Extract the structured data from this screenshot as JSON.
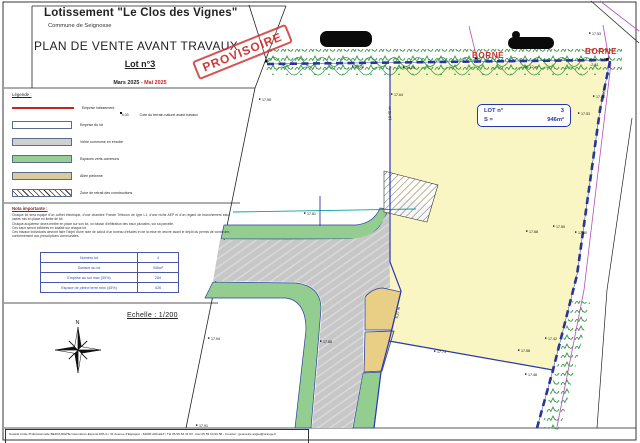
{
  "title_block": {
    "title": "Lotissement \"Le Clos des Vignes\"",
    "commune": "Commune de Seignosse",
    "plan_title": "PLAN DE VENTE AVANT TRAVAUX",
    "lot": "Lot n°3",
    "date_black": "Mars 2025",
    "date_red": "- Mai 2025",
    "stamp": "PROVISOIRE"
  },
  "legend": {
    "heading": "Légende :",
    "items": [
      {
        "swatch": "line-red",
        "label": "Emprise lotissement"
      },
      {
        "swatch": "white",
        "label": "Emprise du lot"
      },
      {
        "swatch": "gray",
        "label": "Voirie commune en enrobé"
      },
      {
        "swatch": "green",
        "label": "Espaces verts communs"
      },
      {
        "swatch": "tan",
        "label": "Allée piétonne"
      },
      {
        "swatch": "hatch",
        "label": "Zone de retrait des constructions"
      }
    ],
    "cote_value": "4.03",
    "cote_label": "Cote du terrain naturel avant travaux"
  },
  "notes": {
    "heading": "Nota importante :",
    "lines": [
      "Chaque lot sera équipé d'un coffret électrique, d'une chambre France Télécom de type L1, d'une niche AEP et d'un regard de branchement eaux usées mis en place en limite de lot.",
      "Chaque acquéreur devra mettre en place sur son lot, un bassin d'infiltration des eaux pluviales, sur sa parcelle.",
      "Ces eaux seront infiltrées en totalité sur chaque lot.",
      "Ces travaux individuels devront faire l'objet d'une note de calcul d'un bureau d'études et de la mise en œuvre avant le dépôt du permis de construire, conformément aux prescriptions communales."
    ]
  },
  "table": {
    "rows": [
      {
        "label": "Numéro lot",
        "value": "4"
      },
      {
        "label": "Surface du lot",
        "value": "946m²"
      },
      {
        "label": "Emprise au sol max (30%)",
        "value": "284"
      },
      {
        "label": "Espace de pleine terre mini (45%)",
        "value": "426"
      }
    ]
  },
  "scale": {
    "label": "Echelle : 1/200"
  },
  "north": {
    "label": "N"
  },
  "footer": {
    "text": "Société Civile Professionnelle BEDOURGHE Géomètres-Experts DPLG / 41 Avenue d'Espagne - 64600 ANGLET / Tél 05 59 63 31 03 - Fax 05 59 63 90 58 - Courriel : geometre.anglet@orange.fr"
  },
  "plan": {
    "lot_box": {
      "line1_label": "LOT n°",
      "line1_value": "3",
      "line2_label": "S =",
      "line2_value": "946m²"
    },
    "borne_labels": [
      {
        "x": 472,
        "y": 58,
        "text": "BORNE"
      },
      {
        "x": 585,
        "y": 54,
        "text": "BORNE"
      }
    ],
    "measurements": [
      {
        "x": 531,
        "y": 68,
        "rot": 0,
        "anchor": "middle",
        "text": "16.12 m"
      },
      {
        "x": 590,
        "y": 66,
        "rot": 0,
        "anchor": "start",
        "text": "-2.81"
      },
      {
        "x": 605,
        "y": 93,
        "rot": -80,
        "anchor": "middle",
        "text": "-7.60 m"
      },
      {
        "x": 391,
        "y": 114,
        "rot": -92,
        "anchor": "middle",
        "text": "-13.45 m"
      },
      {
        "x": 399,
        "y": 313,
        "rot": -78,
        "anchor": "middle",
        "text": "6.27 m"
      }
    ],
    "elevation_points": [
      {
        "x": 262,
        "y": 101,
        "v": "17.90"
      },
      {
        "x": 394,
        "y": 96,
        "v": "17.64"
      },
      {
        "x": 355,
        "y": 68,
        "v": "17.26"
      },
      {
        "x": 406,
        "y": 69,
        "v": "14.29"
      },
      {
        "x": 592,
        "y": 35,
        "v": "17.53"
      },
      {
        "x": 596,
        "y": 98,
        "v": "17.42"
      },
      {
        "x": 581,
        "y": 115,
        "v": "17.53"
      },
      {
        "x": 556,
        "y": 228,
        "v": "17.50"
      },
      {
        "x": 578,
        "y": 234,
        "v": "17.60"
      },
      {
        "x": 529,
        "y": 233,
        "v": "17.68"
      },
      {
        "x": 521,
        "y": 352,
        "v": "17.58"
      },
      {
        "x": 548,
        "y": 340,
        "v": "17.42"
      },
      {
        "x": 528,
        "y": 376,
        "v": "17.48"
      },
      {
        "x": 437,
        "y": 353,
        "v": "17.73"
      },
      {
        "x": 307,
        "y": 215,
        "v": "17.81"
      },
      {
        "x": 211,
        "y": 340,
        "v": "17.94"
      },
      {
        "x": 323,
        "y": 343,
        "v": "17.88"
      },
      {
        "x": 199,
        "y": 427,
        "v": "17.91"
      }
    ]
  },
  "colors": {
    "boundary_navy": "#28339b",
    "lot_fill": "#faf6c3",
    "green": "#93cd90",
    "road_gray": "#c7c7c7",
    "walkway_tan": "#e9cf85",
    "red": "#cc2222",
    "magenta": "#b84db8",
    "teal": "#00a2a2",
    "table_blue": "#2f49b8"
  }
}
